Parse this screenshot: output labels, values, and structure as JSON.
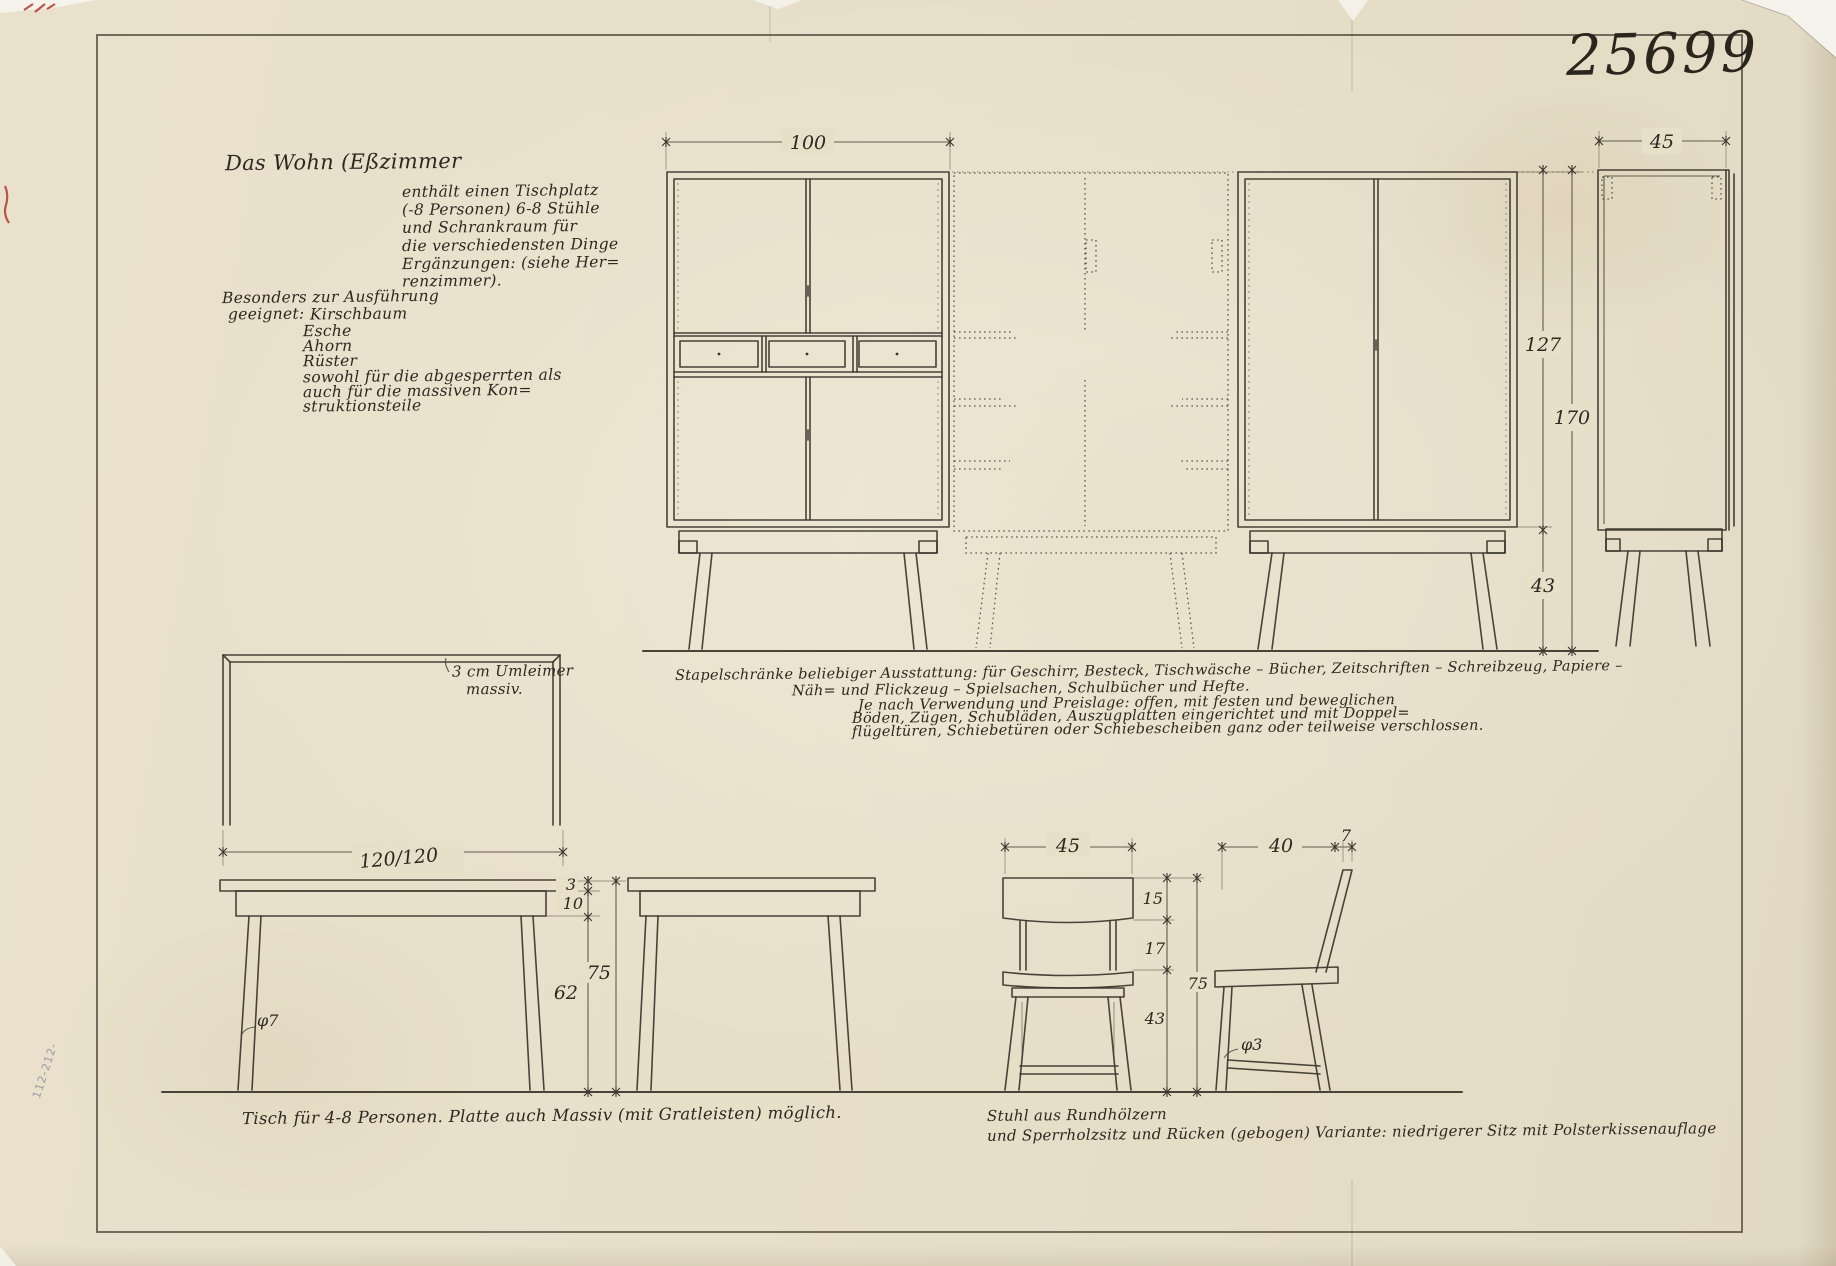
{
  "drawing_number": "25699",
  "margin_mark": "112-212-",
  "colors": {
    "paper": "#e8dfc9",
    "ink": "#2d2820",
    "line": "#3a352b",
    "red_mark": "#b03a2c"
  },
  "notes": {
    "heading": "Das Wohn (Eßzimmer",
    "intro": [
      "enthält einen Tischplatz",
      "(-8 Personen) 6-8 Stühle",
      "und Schrankraum für",
      "die verschiedensten Dinge",
      "Ergänzungen: (siehe Her=",
      "renzimmer)."
    ],
    "materials_intro": "Besonders zur Ausführung",
    "materials_label": "geeignet:",
    "materials": [
      "Kirschbaum",
      "Esche",
      "Ahorn",
      "Rüster",
      "sowohl für die abgesperrten als",
      "auch für die massiven Kon=",
      "struktionsteile"
    ]
  },
  "cabinets": {
    "dim_width": "100",
    "dim_side_width": "45",
    "dim_body_height": "127",
    "dim_total_height": "170",
    "dim_leg_height": "43",
    "caption": [
      "Stapelschränke beliebiger Ausstattung: für Geschirr, Besteck, Tischwäsche – Bücher, Zeitschriften – Schreibzeug, Papiere –",
      "Näh= und Flickzeug – Spielsachen, Schulbücher und Hefte.",
      "Je nach Verwendung und Preislage: offen, mit festen und beweglichen",
      "Böden, Zügen, Schubläden, Auszugplatten eingerichtet und mit Doppel=",
      "flügeltüren, Schiebetüren oder Schiebescheiben ganz oder teilweise verschlossen."
    ]
  },
  "table": {
    "plan_note": [
      "3 cm Umleimer",
      "massiv."
    ],
    "dim_plan": "120/120",
    "dim_top": "3",
    "dim_apron": "10",
    "dim_clear": "62",
    "dim_height": "75",
    "leg_note": "φ7",
    "caption": "Tisch für 4-8 Personen.  Platte auch Massiv (mit Gratleisten) möglich."
  },
  "chairs": {
    "dim_front_width": "45",
    "dim_depth": "40",
    "dim_back_offset": "7",
    "dim_back": "15",
    "dim_gap": "17",
    "dim_seat": "43",
    "dim_height": "75",
    "leg_note": "φ3",
    "caption": [
      "Stuhl aus Rundhölzern",
      "und Sperrholzsitz und Rücken (gebogen)   Variante: niedrigerer Sitz mit Polsterkissenauflage"
    ]
  }
}
